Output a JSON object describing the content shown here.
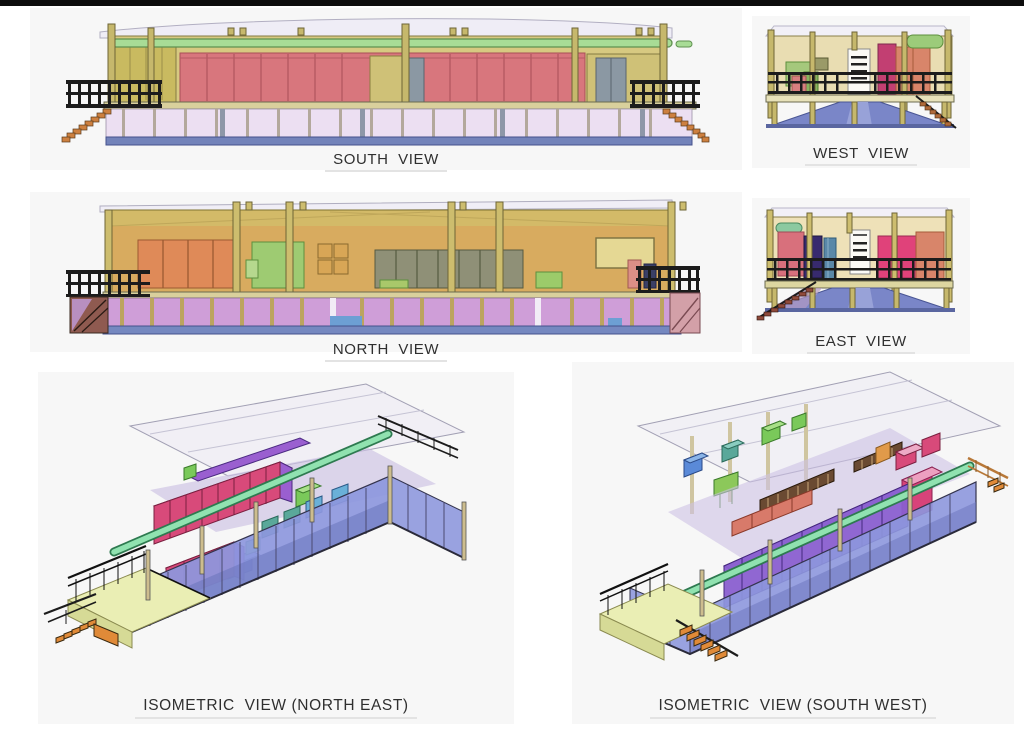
{
  "page": {
    "title": "Building elevation and isometric CAD views",
    "top_bar_color": "#0d0d0d",
    "background": "#ffffff"
  },
  "views": {
    "south": {
      "label": "SOUTH  VIEW"
    },
    "west": {
      "label": "WEST  VIEW"
    },
    "north": {
      "label": "NORTH  VIEW"
    },
    "east": {
      "label": "EAST  VIEW"
    },
    "iso_ne": {
      "label": "ISOMETRIC  VIEW (NORTH EAST)"
    },
    "iso_sw": {
      "label": "ISOMETRIC  VIEW (SOUTH WEST)"
    }
  },
  "palette": {
    "red_panel": "#d8767d",
    "green_beam": "#a8dc96",
    "khaki_wall": "#d7c981",
    "gold_wall": "#d3ba68",
    "orange_panel": "#df8a58",
    "green_box": "#9ecb72",
    "olive_rack": "#8f9077",
    "lavender_floor": "#ecdff2",
    "plum_floor": "#cf9ed8",
    "base_blue": "#7383ba",
    "periwinkle_wall": "#8d97dd",
    "deck_yellow": "#eaeeb4",
    "stair_orange": "#e08a38",
    "magenta": "#e0427a",
    "purple_rack": "#8a5fd0",
    "crimson_slab": "#c23f72",
    "salmon": "#d8856a",
    "navy_box": "#372a6e",
    "teal_slab": "#5a88a8",
    "railing_black": "#1c1c1c"
  }
}
